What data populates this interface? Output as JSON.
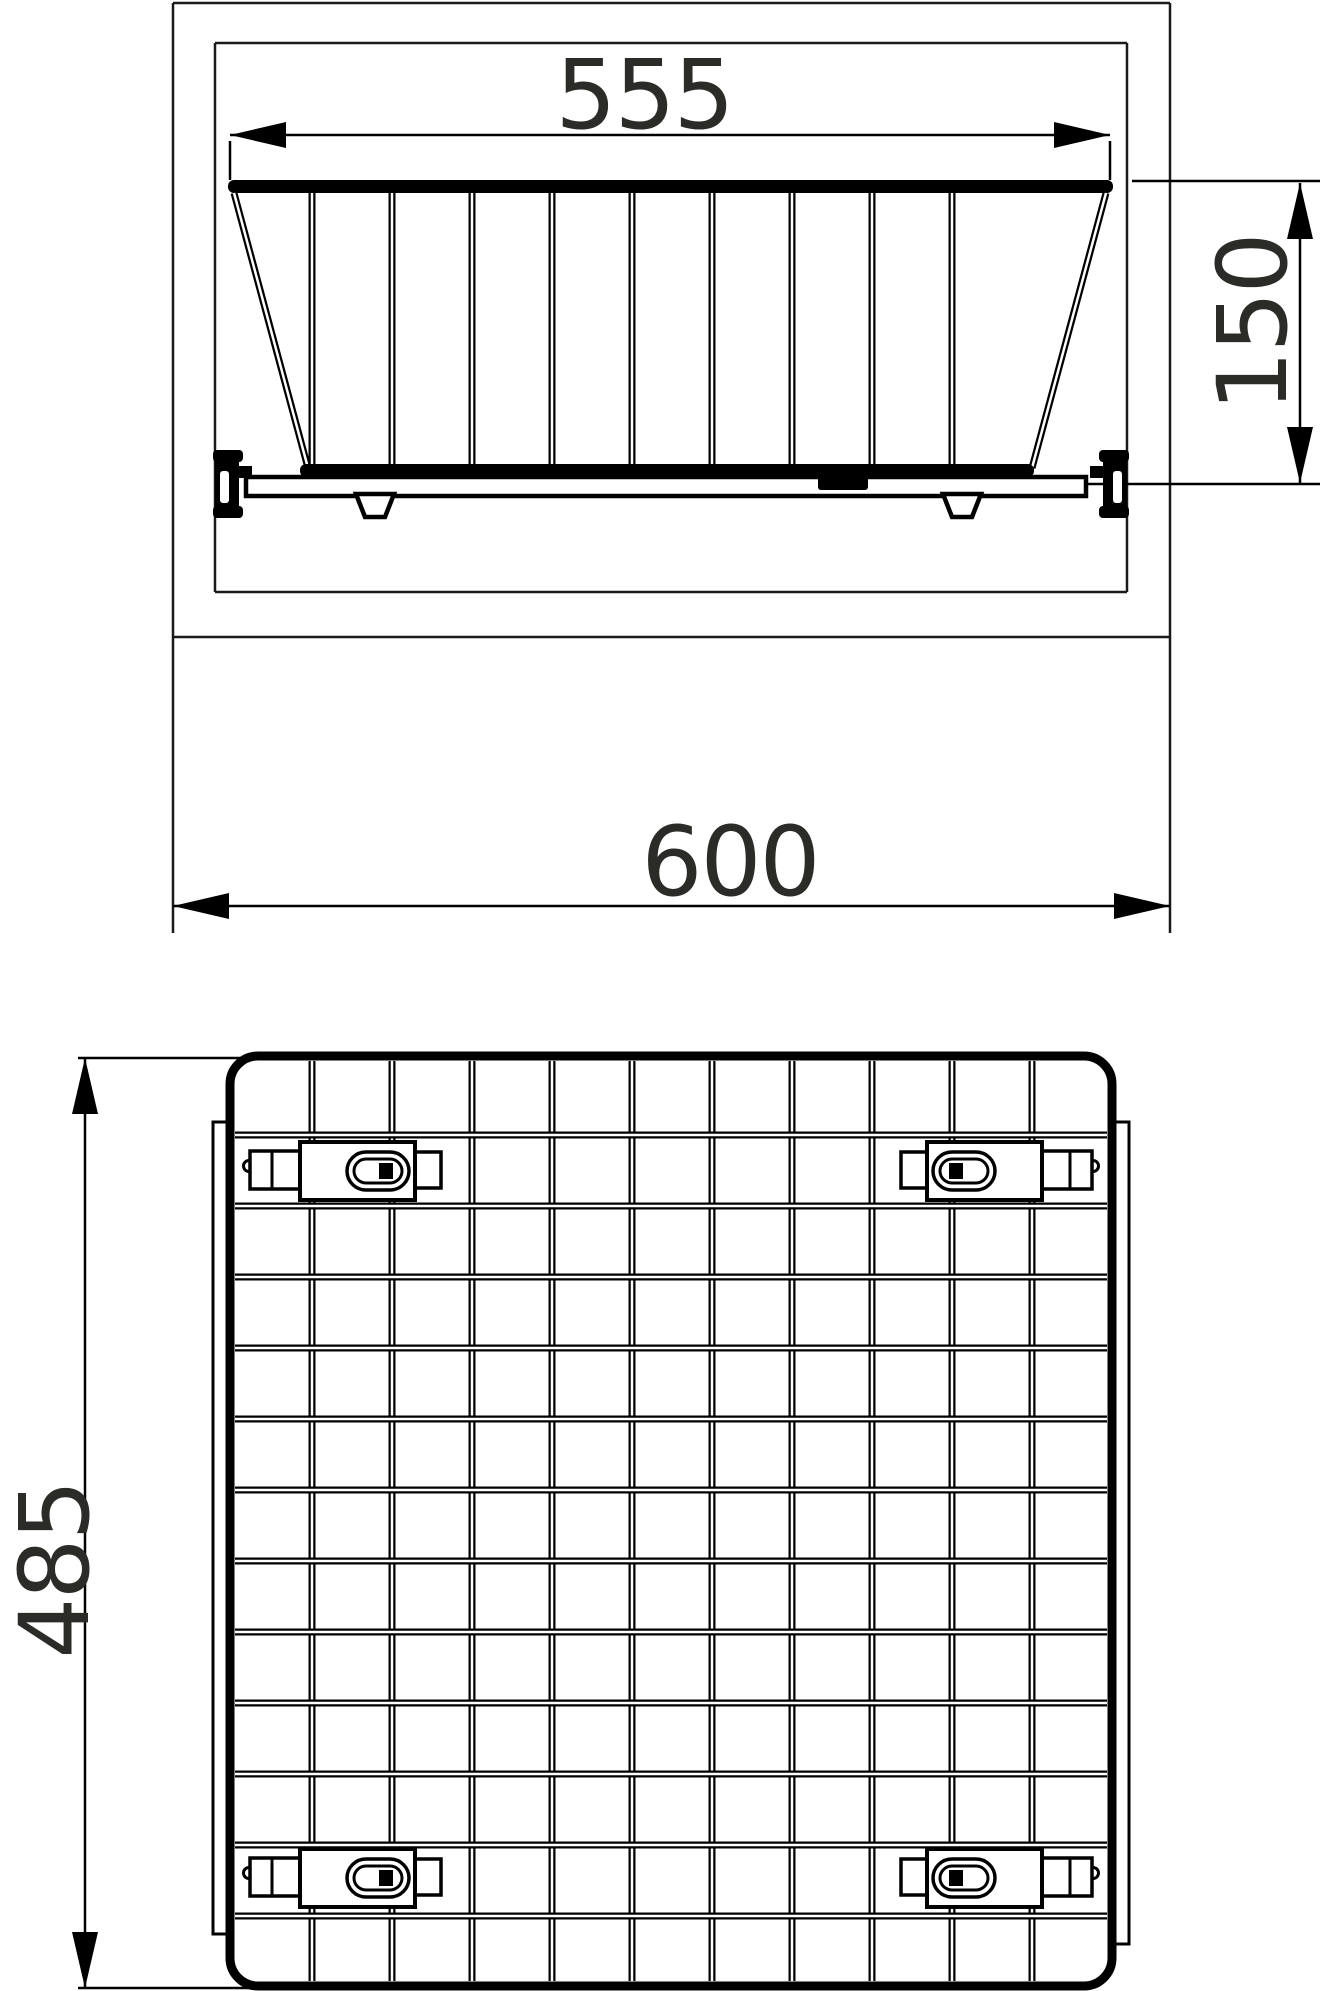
{
  "title": "Pull-out wire basket technical drawing",
  "colors": {
    "background": "#ffffff",
    "line": "#000000",
    "cabinet_line": "#1a1a1a",
    "text": "#2b2b28"
  },
  "front_view": {
    "description": "front elevation of wire basket mounted inside cabinet",
    "dim_top_width": "555",
    "dim_height": "150",
    "dim_cabinet_width": "600",
    "vertical_wire_count": 9
  },
  "plan_view": {
    "description": "bottom plan view of wire mesh basket with runners and clips",
    "dim_depth": "485",
    "grid_columns": 11,
    "grid_rows": 13,
    "clip_count": 4
  }
}
